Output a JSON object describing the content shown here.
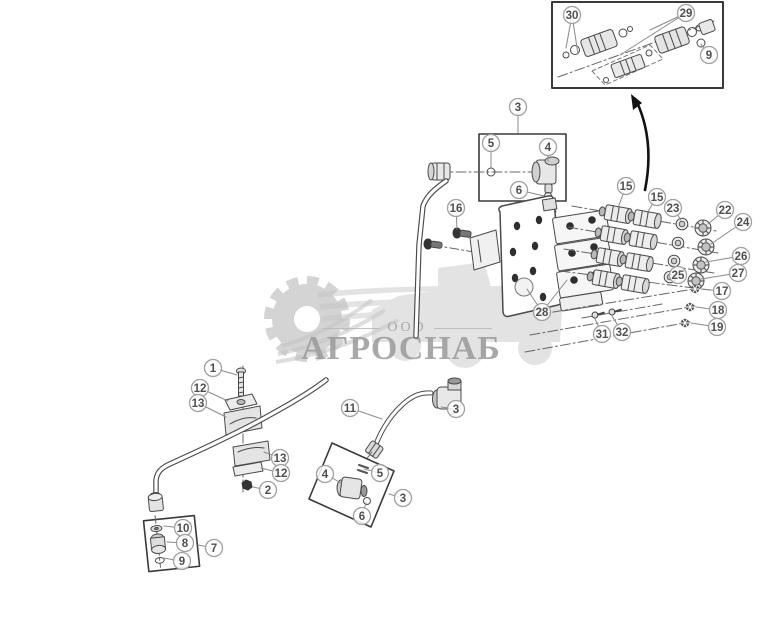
{
  "watermark": {
    "org_form": "ООО",
    "name": "АГРОСНАБ"
  },
  "style": {
    "line_color": "#4a4a4a",
    "balloon_stroke": "#a0a0a0",
    "balloon_text": "#4f4f4f",
    "leader_color": "#8a8a8a",
    "arrow_color": "#111111",
    "watermark_gray": "#c3c3c3",
    "watermark_text": "#9a9a9a"
  },
  "callouts": [
    {
      "label": "30",
      "x": 572,
      "y": 15,
      "leaders": [
        [
          566,
          48
        ],
        [
          578,
          54
        ]
      ]
    },
    {
      "label": "29",
      "x": 686,
      "y": 13,
      "leaders": [
        [
          650,
          30
        ],
        [
          620,
          55
        ]
      ]
    },
    {
      "label": "9",
      "x": 709,
      "y": 55,
      "leaders": [
        [
          701,
          44
        ]
      ]
    },
    {
      "label": "3",
      "x": 518,
      "y": 107,
      "leaders": [
        [
          518,
          133
        ]
      ]
    },
    {
      "label": "5",
      "x": 491,
      "y": 143,
      "leaders": [
        [
          491,
          167
        ]
      ]
    },
    {
      "label": "4",
      "x": 548,
      "y": 147,
      "leaders": [
        [
          548,
          161
        ]
      ]
    },
    {
      "label": "6",
      "x": 519,
      "y": 190,
      "leaders": [
        [
          544,
          196
        ]
      ]
    },
    {
      "label": "16",
      "x": 456,
      "y": 208,
      "leaders": [
        [
          457,
          229
        ]
      ]
    },
    {
      "label": "15",
      "x": 626,
      "y": 186,
      "leaders": [
        [
          618,
          208
        ]
      ]
    },
    {
      "label": "15",
      "x": 657,
      "y": 197,
      "leaders": [
        [
          647,
          213
        ]
      ]
    },
    {
      "label": "23",
      "x": 673,
      "y": 208,
      "leaders": [
        [
          681,
          220
        ]
      ]
    },
    {
      "label": "22",
      "x": 725,
      "y": 210,
      "leaders": [
        [
          708,
          224
        ]
      ]
    },
    {
      "label": "24",
      "x": 743,
      "y": 222,
      "leaders": [
        [
          711,
          244
        ]
      ]
    },
    {
      "label": "26",
      "x": 741,
      "y": 256,
      "leaders": [
        [
          706,
          262
        ]
      ]
    },
    {
      "label": "27",
      "x": 738,
      "y": 273,
      "leaders": [
        [
          701,
          279
        ]
      ]
    },
    {
      "label": "25",
      "x": 678,
      "y": 275,
      "leaders": [
        [
          673,
          266
        ]
      ]
    },
    {
      "label": "17",
      "x": 722,
      "y": 291,
      "leaders": [
        [
          701,
          289
        ]
      ]
    },
    {
      "label": "18",
      "x": 718,
      "y": 310,
      "leaders": [
        [
          696,
          307
        ]
      ]
    },
    {
      "label": "19",
      "x": 717,
      "y": 327,
      "leaders": [
        [
          691,
          323
        ]
      ]
    },
    {
      "label": "31",
      "x": 602,
      "y": 334,
      "leaders": [
        [
          595,
          319
        ]
      ]
    },
    {
      "label": "32",
      "x": 622,
      "y": 332,
      "leaders": [
        [
          612,
          316
        ]
      ]
    },
    {
      "label": "28",
      "x": 542,
      "y": 312,
      "leaders": [
        [
          527,
          289
        ],
        [
          567,
          280
        ]
      ]
    },
    {
      "label": "1",
      "x": 213,
      "y": 368,
      "leaders": [
        [
          237,
          375
        ]
      ]
    },
    {
      "label": "12",
      "x": 200,
      "y": 388,
      "leaders": [
        [
          228,
          401
        ]
      ]
    },
    {
      "label": "13",
      "x": 198,
      "y": 403,
      "leaders": [
        [
          226,
          417
        ]
      ]
    },
    {
      "label": "13",
      "x": 280,
      "y": 458,
      "leaders": [
        [
          264,
          452
        ]
      ]
    },
    {
      "label": "12",
      "x": 281,
      "y": 473,
      "leaders": [
        [
          261,
          468
        ]
      ]
    },
    {
      "label": "2",
      "x": 268,
      "y": 490,
      "leaders": [
        [
          253,
          487
        ]
      ]
    },
    {
      "label": "11",
      "x": 350,
      "y": 408,
      "leaders": [
        [
          382,
          419
        ]
      ]
    },
    {
      "label": "3",
      "x": 456,
      "y": 409,
      "leaders": [
        [
          441,
          407
        ]
      ]
    },
    {
      "label": "4",
      "x": 325,
      "y": 474,
      "leaders": [
        [
          341,
          483
        ]
      ]
    },
    {
      "label": "5",
      "x": 380,
      "y": 473,
      "leaders": [
        [
          364,
          469
        ]
      ]
    },
    {
      "label": "6",
      "x": 362,
      "y": 516,
      "leaders": [
        [
          366,
          503
        ]
      ]
    },
    {
      "label": "3",
      "x": 403,
      "y": 498,
      "leaders": [
        [
          389,
          494
        ]
      ]
    },
    {
      "label": "10",
      "x": 183,
      "y": 528,
      "leaders": [
        [
          164,
          526
        ]
      ]
    },
    {
      "label": "8",
      "x": 185,
      "y": 543,
      "leaders": [
        [
          167,
          542
        ]
      ]
    },
    {
      "label": "9",
      "x": 182,
      "y": 561,
      "leaders": [
        [
          163,
          558
        ]
      ]
    },
    {
      "label": "7",
      "x": 214,
      "y": 548,
      "leaders": [
        [
          198,
          545
        ]
      ]
    }
  ]
}
